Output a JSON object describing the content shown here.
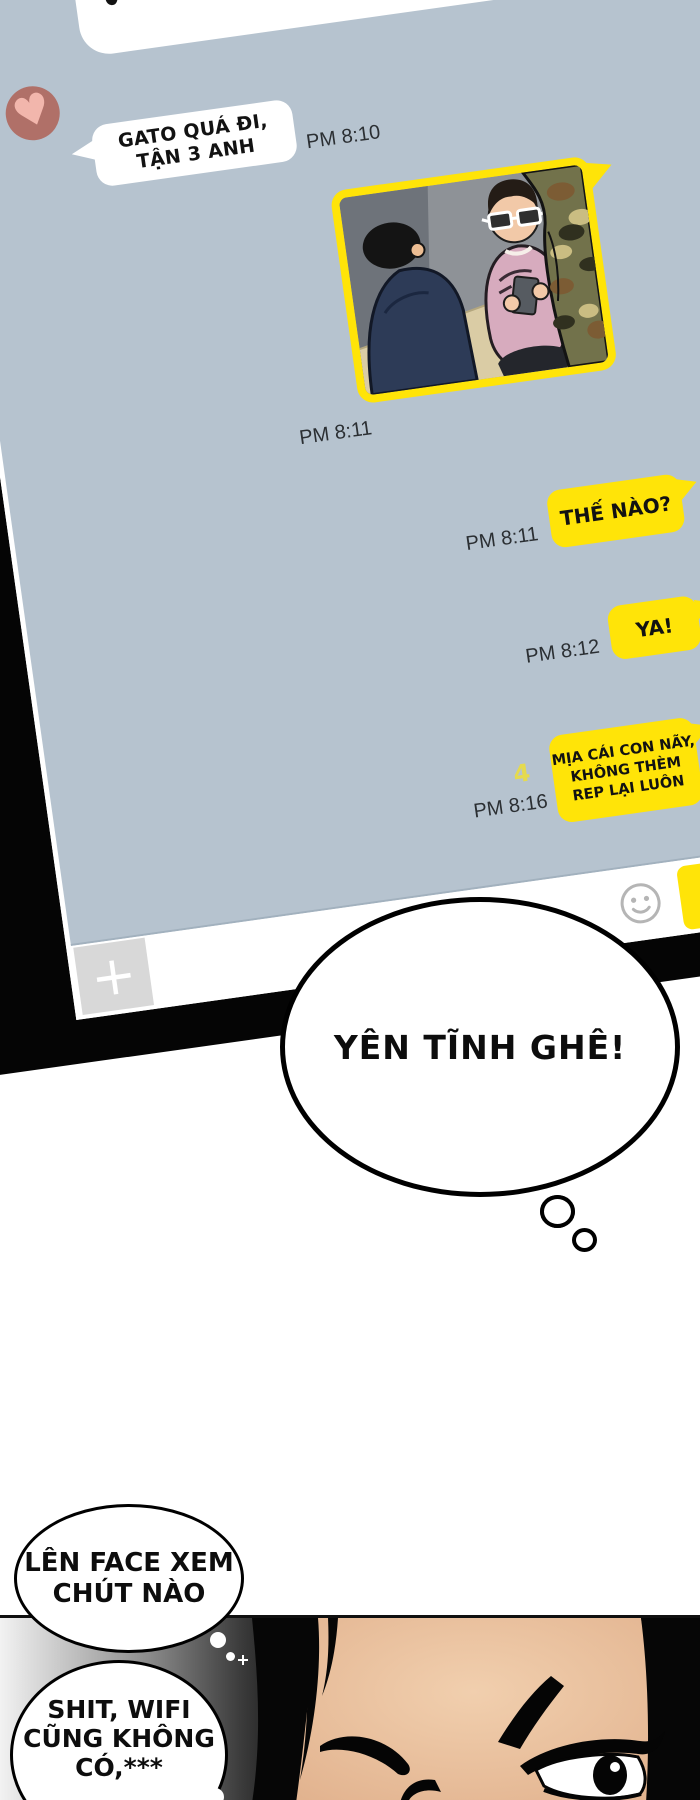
{
  "comic": {
    "colors": {
      "chat_bg": "#b6c3cf",
      "bubble_yellow": "#ffe408",
      "avatar_bg": "#b07068",
      "heart_pink": "#f2b6ac",
      "unread_yellow": "#e5da4e",
      "panel_bg": "#000000"
    },
    "chat_app": {
      "contact_avatar": {
        "icon": "heart-icon",
        "heart_glyph": "♥"
      },
      "messages": [
        {
          "direction": "received",
          "lines": [
            "GATO QUÁ ĐI,",
            "TẬN 3 ANH"
          ],
          "time": "PM 8:10"
        },
        {
          "direction": "sent",
          "kind": "photo",
          "time": "PM 8:11",
          "photo_desc": "three-friends-sitting-illustration"
        },
        {
          "direction": "sent",
          "text": "THẾ NÀO?",
          "time": "PM 8:11"
        },
        {
          "direction": "sent",
          "text": "YA!",
          "time": "PM 8:12"
        },
        {
          "direction": "sent",
          "lines": [
            "MỊA CÁI CON NÃY,",
            "KHÔNG THÈM",
            "REP LẠI LUÔN"
          ],
          "time": "PM 8:16",
          "unread_count": "4"
        }
      ],
      "input_bar": {
        "attach_label": "+",
        "emoticon_icon": "smiley-icon",
        "send_button": ""
      }
    },
    "balloons": {
      "thought_main": "YÊN TĨNH GHÊ!",
      "speech_face": [
        "LÊN FACE XEM",
        "CHÚT NÀO"
      ],
      "thought_wifi": [
        "SHIT, WIFI",
        "CŨNG KHÔNG",
        "CÓ,***"
      ]
    }
  }
}
